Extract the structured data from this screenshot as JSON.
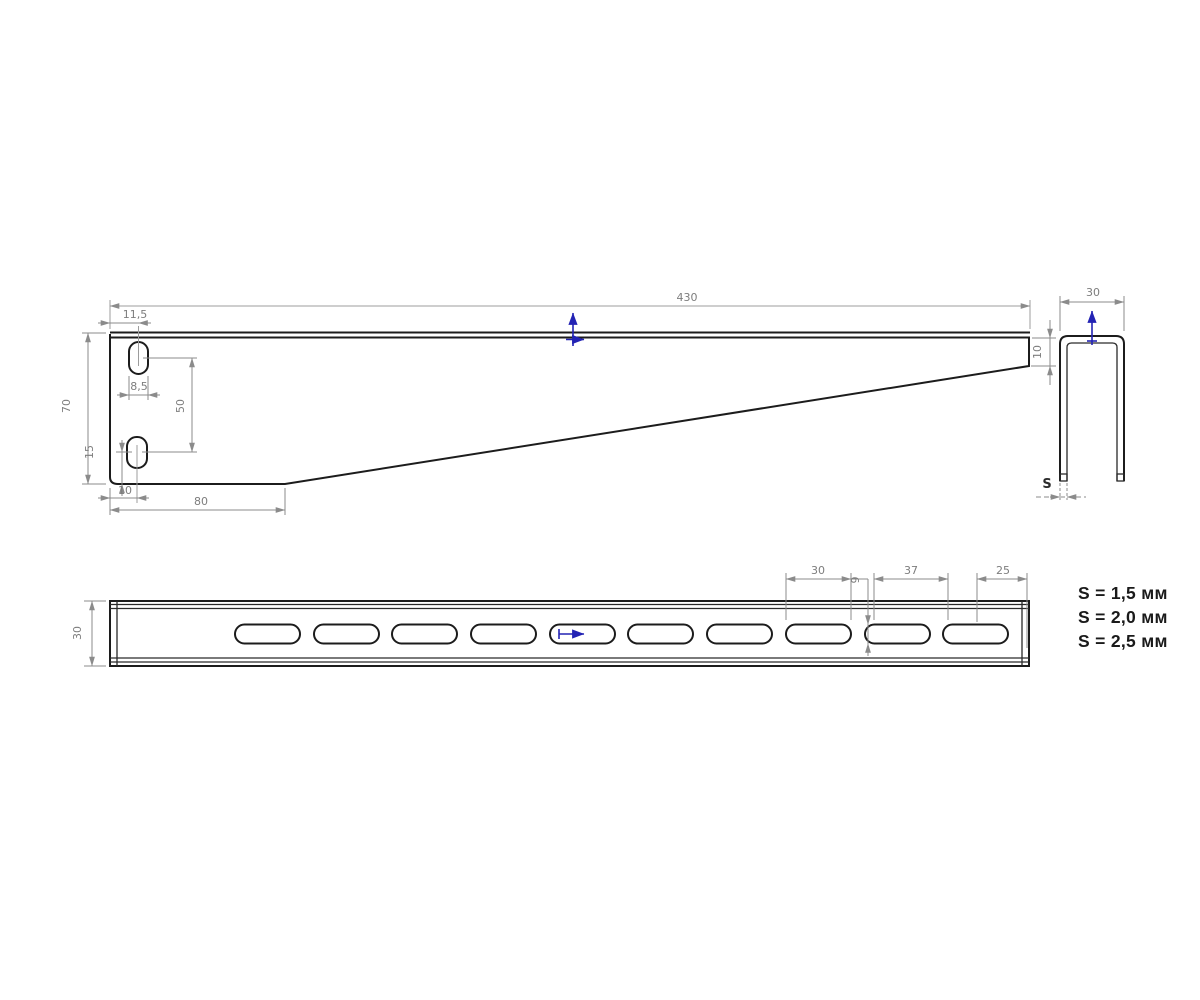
{
  "drawing_type": "bracket-technical-drawing",
  "accent_blue": "#2323b4",
  "views": {
    "side": {
      "label": "side-view",
      "dims": {
        "length": "430",
        "height": "70",
        "slot_offset_top": "11,5",
        "slot_width": "8,5",
        "slot_center_distance": "50",
        "slot_offset_bottom": "15",
        "slot_edge_offset": "10",
        "base_length": "80",
        "tip_height": "10"
      }
    },
    "end": {
      "label": "end-view",
      "dims": {
        "width": "30",
        "thickness": "S"
      }
    },
    "top": {
      "label": "top-view",
      "dims": {
        "height": "30",
        "slot_length": "30",
        "slot_width": "9",
        "slot_pitch": "37",
        "end_offset": "25"
      }
    }
  },
  "thickness_options": [
    "S = 1,5 мм",
    "S = 2,0 мм",
    "S = 2,5 мм"
  ]
}
